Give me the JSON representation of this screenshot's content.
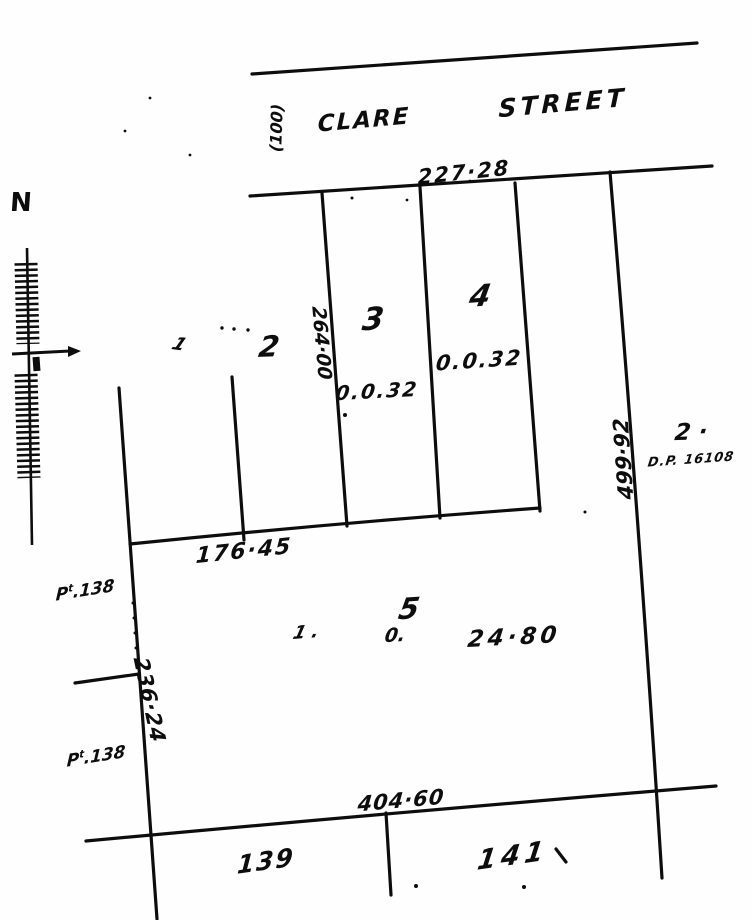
{
  "street": {
    "name_first": "CLARE",
    "name_second": "STREET",
    "width_note": "(100)"
  },
  "north_arrow": {
    "label": "N"
  },
  "lots": {
    "lot1": "1",
    "lot2": "2",
    "lot3": "3",
    "lot4": "4",
    "lot5": "5",
    "lot139": "139",
    "lot141": "141"
  },
  "areas": {
    "lot3": "0.0.32",
    "lot4": "0.0.32",
    "lot5_acres": "1 .",
    "lot5_roods": "0.",
    "lot5_perches": "24·80"
  },
  "dimensions": {
    "street_frontage": "227·28",
    "lot_depth": "264·00",
    "back_line": "176·45",
    "west_side": "236·24",
    "east_side": "499·92",
    "south_line": "404·60"
  },
  "adjoining": {
    "lot_number": "2 ·",
    "dp_reference": "D.P. 16108",
    "pt_prefix": "P",
    "pt_sup": "t",
    "pt_rest": ".138"
  }
}
